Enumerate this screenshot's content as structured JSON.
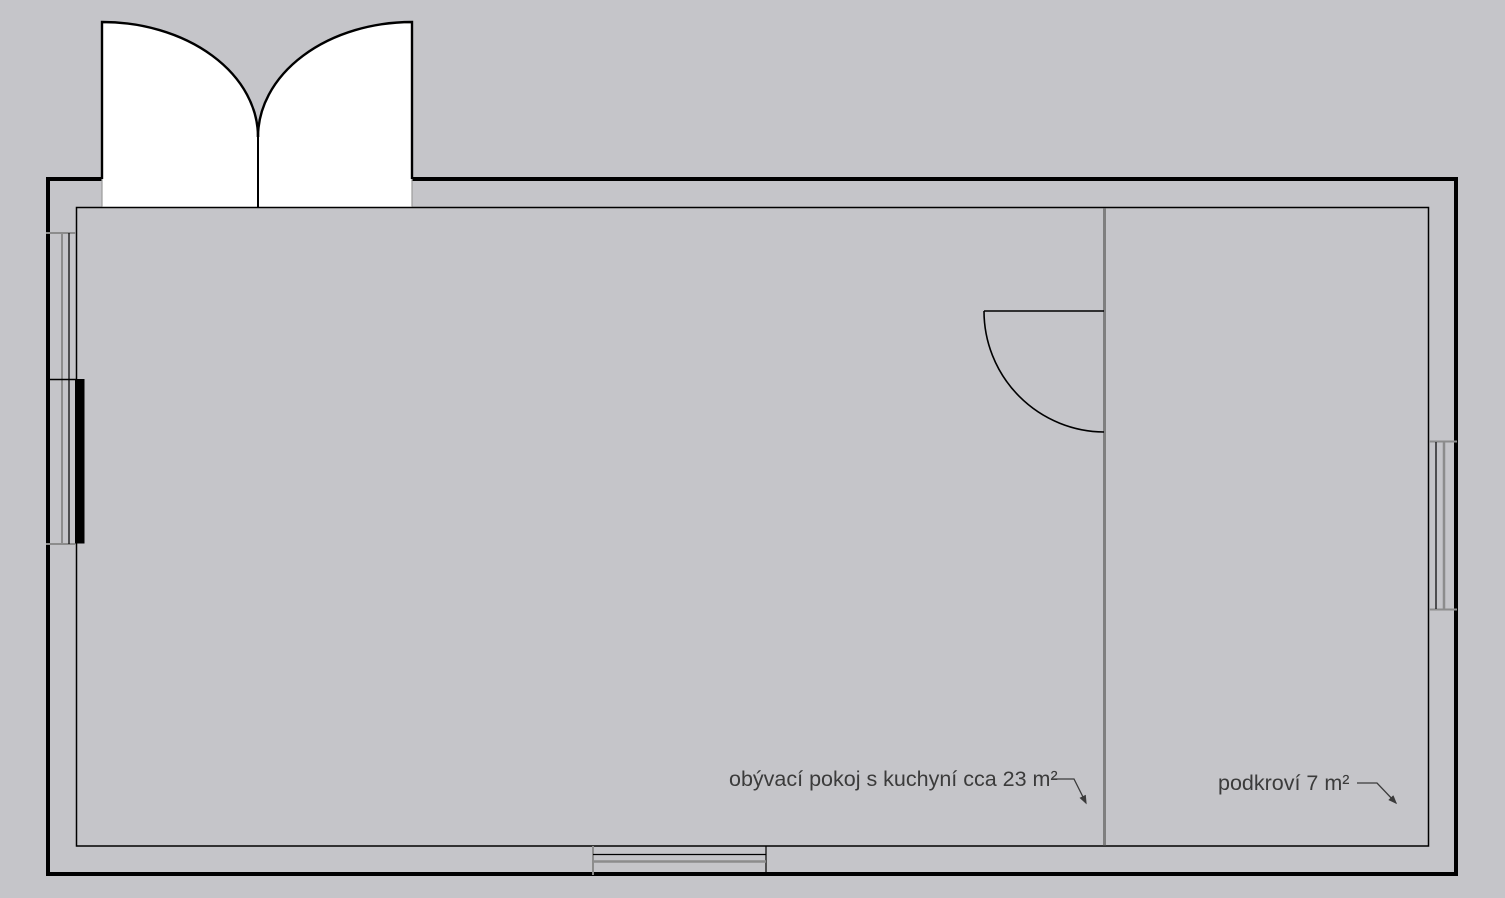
{
  "colors": {
    "background": "#c5c5c9",
    "floor": "#ffffff",
    "wall": "#000000",
    "partition": "#7f7f7f",
    "window_frame": "#8c8c8c",
    "text": "#3b3b3b"
  },
  "labels": {
    "living_room": {
      "text": "obývací pokoj s kuchyní cca 23 m²"
    },
    "attic": {
      "text": "podkroví 7 m²"
    }
  }
}
